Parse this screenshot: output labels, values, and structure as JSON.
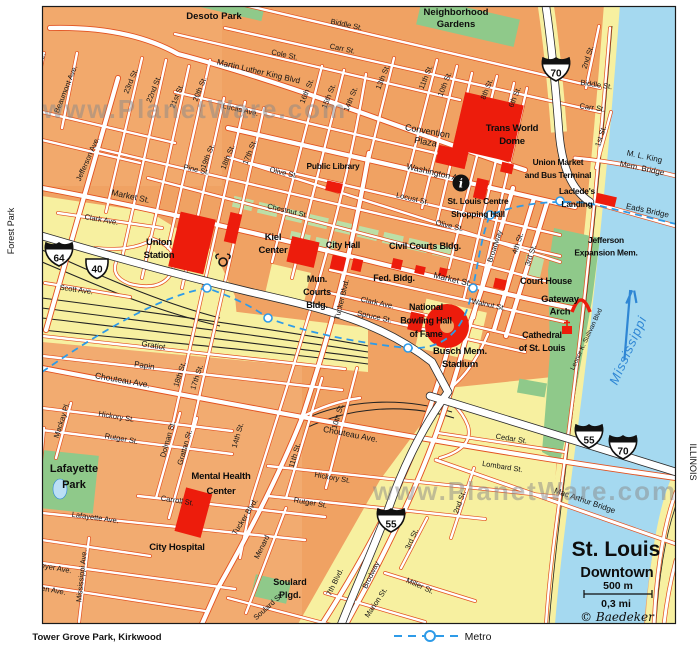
{
  "watermark": "www.PlanetWare.com",
  "title_block": {
    "title": "St. Louis",
    "subtitle": "Downtown",
    "scale_metric": "500 m",
    "scale_imperial": "0,3 mi",
    "credit": "© Baedeker"
  },
  "legend": {
    "metro_label": "Metro",
    "direction_label": "Tower Grove Park, Kirkwood"
  },
  "margin_labels": {
    "left": "Forest Park",
    "right": "ILLINOIS"
  },
  "river_label": "Mississippi",
  "colors": {
    "block_orange": "#f0a263",
    "street_casing": "#e2511f",
    "park_green": "#8fc98a",
    "plaza_green": "#bcdfa6",
    "highway_yellow": "#f7f0a0",
    "river_blue": "#a5d9f0",
    "landmark_red": "#ed1c0c",
    "metro_blue": "#2e9be8"
  },
  "shields": [
    {
      "type": "interstate",
      "num": "70",
      "x": 556,
      "y": 69
    },
    {
      "type": "interstate",
      "num": "64",
      "x": 59,
      "y": 254
    },
    {
      "type": "us",
      "num": "40",
      "x": 97,
      "y": 268
    },
    {
      "type": "interstate",
      "num": "55",
      "x": 391,
      "y": 520
    },
    {
      "type": "interstate",
      "num": "55",
      "x": 589,
      "y": 436
    },
    {
      "type": "interstate",
      "num": "70",
      "x": 623,
      "y": 447
    }
  ],
  "street_labels": [
    {
      "t": "Biddle St.",
      "x": 346,
      "y": 27,
      "r": 12
    },
    {
      "t": "Carr St.",
      "x": 342,
      "y": 51,
      "r": 12
    },
    {
      "t": "Cole St.",
      "x": 284,
      "y": 57,
      "r": 12
    },
    {
      "t": "Martin Luther King Blvd",
      "x": 258,
      "y": 74,
      "r": 13,
      "s": 8.2
    },
    {
      "t": "Lucas Ave.",
      "x": 240,
      "y": 112,
      "r": 13
    },
    {
      "t": "Biddle St.",
      "x": 596,
      "y": 87,
      "r": 8
    },
    {
      "t": "Carr St.",
      "x": 592,
      "y": 110,
      "r": 8
    },
    {
      "l": [
        "Convention",
        "Plaza"
      ],
      "x": 427,
      "y": 134,
      "r": 10,
      "s": 9,
      "lh": 11
    },
    {
      "t": "Washington Ave.",
      "x": 437,
      "y": 176,
      "r": 13,
      "s": 8.5
    },
    {
      "t": "Locust St.",
      "x": 412,
      "y": 201,
      "r": 13
    },
    {
      "t": "Olive St.",
      "x": 283,
      "y": 175,
      "r": 13
    },
    {
      "t": "Olive St.",
      "x": 449,
      "y": 228,
      "r": 13
    },
    {
      "t": "Pine St.",
      "x": 196,
      "y": 172,
      "r": 12
    },
    {
      "t": "Chestnut St.",
      "x": 287,
      "y": 213,
      "r": 13
    },
    {
      "t": "Market St.",
      "x": 130,
      "y": 199,
      "r": 12,
      "s": 8.5
    },
    {
      "t": "Market St.",
      "x": 452,
      "y": 282,
      "r": 13,
      "s": 8.5
    },
    {
      "t": "Walnut St.",
      "x": 488,
      "y": 307,
      "r": 12
    },
    {
      "t": "Clark Ave.",
      "x": 101,
      "y": 222,
      "r": 10
    },
    {
      "t": "Clark Ave.",
      "x": 377,
      "y": 305,
      "r": 12
    },
    {
      "t": "Scott Ave.",
      "x": 76,
      "y": 292,
      "r": 8
    },
    {
      "t": "Spruce St.",
      "x": 374,
      "y": 319,
      "r": 12
    },
    {
      "t": "Gratiot",
      "x": 153,
      "y": 348,
      "r": 9,
      "s": 8
    },
    {
      "t": "Papin",
      "x": 144,
      "y": 368,
      "r": 9,
      "s": 8
    },
    {
      "t": "Chouteau Ave.",
      "x": 122,
      "y": 383,
      "r": 10,
      "s": 8.5
    },
    {
      "t": "Chouteau Ave.",
      "x": 350,
      "y": 437,
      "r": 11,
      "s": 8.5
    },
    {
      "t": "Hickory St.",
      "x": 116,
      "y": 419,
      "r": 10
    },
    {
      "t": "Hickory St.",
      "x": 332,
      "y": 480,
      "r": 10
    },
    {
      "t": "Rutger St.",
      "x": 121,
      "y": 441,
      "r": 10
    },
    {
      "t": "Rutger St.",
      "x": 310,
      "y": 505,
      "r": 10
    },
    {
      "t": "Carroll St.",
      "x": 177,
      "y": 503,
      "r": 9
    },
    {
      "t": "Lafayette Ave.",
      "x": 95,
      "y": 520,
      "r": 8
    },
    {
      "t": "Geyer Ave.",
      "x": 53,
      "y": 570,
      "r": 10
    },
    {
      "t": "Allen Ave.",
      "x": 49,
      "y": 592,
      "r": 10
    },
    {
      "t": "Cedar St.",
      "x": 511,
      "y": 441,
      "r": 9
    },
    {
      "t": "Lombard St.",
      "x": 502,
      "y": 469,
      "r": 9
    },
    {
      "t": "23rd St.",
      "x": 133,
      "y": 82,
      "r": -68
    },
    {
      "t": "22nd St.",
      "x": 156,
      "y": 90,
      "r": -68
    },
    {
      "t": "21st St.",
      "x": 179,
      "y": 97,
      "r": -68
    },
    {
      "t": "20th St.",
      "x": 202,
      "y": 90,
      "r": -68
    },
    {
      "t": "19th St.",
      "x": 210,
      "y": 157,
      "r": -68
    },
    {
      "t": "18th St.",
      "x": 230,
      "y": 158,
      "r": -68
    },
    {
      "t": "17th St.",
      "x": 252,
      "y": 153,
      "r": -68
    },
    {
      "t": "16th St.",
      "x": 309,
      "y": 92,
      "r": -68
    },
    {
      "t": "15th St.",
      "x": 331,
      "y": 97,
      "r": -68
    },
    {
      "t": "14th St.",
      "x": 353,
      "y": 100,
      "r": -68
    },
    {
      "t": "13th St.",
      "x": 385,
      "y": 78,
      "r": -68
    },
    {
      "t": "11th St.",
      "x": 428,
      "y": 78,
      "r": -68
    },
    {
      "t": "10th St.",
      "x": 447,
      "y": 85,
      "r": -68
    },
    {
      "t": "8th St.",
      "x": 489,
      "y": 90,
      "r": -68
    },
    {
      "t": "6th St.",
      "x": 517,
      "y": 98,
      "r": -68
    },
    {
      "t": "2nd St.",
      "x": 590,
      "y": 58,
      "r": -72
    },
    {
      "t": "1st St.",
      "x": 603,
      "y": 137,
      "r": -72
    },
    {
      "t": "Leffingwell Ave.",
      "x": 36,
      "y": 78,
      "r": -68
    },
    {
      "t": "Beaumont Ave.",
      "x": 68,
      "y": 90,
      "r": -68
    },
    {
      "t": "Jefferson Ave.",
      "x": 90,
      "y": 160,
      "r": -66
    },
    {
      "t": "Tucker Blvd.",
      "x": 344,
      "y": 300,
      "r": -76
    },
    {
      "t": "Tucker Blvd.",
      "x": 247,
      "y": 518,
      "r": -58
    },
    {
      "t": "Broadway",
      "x": 497,
      "y": 247,
      "r": -72
    },
    {
      "t": "4th St.",
      "x": 520,
      "y": 244,
      "r": -72
    },
    {
      "t": "3rd St.",
      "x": 533,
      "y": 256,
      "r": -72
    },
    {
      "t": "18th St.",
      "x": 182,
      "y": 375,
      "r": -72
    },
    {
      "t": "17th St.",
      "x": 199,
      "y": 378,
      "r": -72
    },
    {
      "t": "14th St.",
      "x": 240,
      "y": 436,
      "r": -74
    },
    {
      "t": "11th St.",
      "x": 297,
      "y": 456,
      "r": -74
    },
    {
      "t": "10th St.",
      "x": 340,
      "y": 417,
      "r": -74
    },
    {
      "t": "Dolman St.",
      "x": 170,
      "y": 440,
      "r": -74
    },
    {
      "t": "Grattan St.",
      "x": 187,
      "y": 448,
      "r": -74
    },
    {
      "t": "Mackay Pl.",
      "x": 64,
      "y": 421,
      "r": -72
    },
    {
      "t": "Missouri Ave.",
      "x": 37,
      "y": 458,
      "r": -81
    },
    {
      "t": "Mississippi Ave.",
      "x": 84,
      "y": 576,
      "r": -84
    },
    {
      "t": "Menard",
      "x": 264,
      "y": 548,
      "r": -64
    },
    {
      "t": "Soulard St.",
      "x": 270,
      "y": 608,
      "r": -42
    },
    {
      "t": "7th Blvd.",
      "x": 337,
      "y": 583,
      "r": -64
    },
    {
      "t": "Brodway",
      "x": 373,
      "y": 576,
      "r": -64
    },
    {
      "t": "Marion St.",
      "x": 378,
      "y": 604,
      "r": -56
    },
    {
      "t": "Miller St.",
      "x": 419,
      "y": 588,
      "r": 24
    },
    {
      "t": "3rd St.",
      "x": 414,
      "y": 540,
      "r": -66
    },
    {
      "t": "2nd St.",
      "x": 462,
      "y": 503,
      "r": -70
    },
    {
      "t": "Leonor K. Sullivan Blvd",
      "x": 588,
      "y": 340,
      "r": -65,
      "s": 6.5
    }
  ],
  "landmark_labels": [
    {
      "l": [
        "Trans World",
        "Dome"
      ],
      "x": 512,
      "y": 131,
      "s": 9.5,
      "lh": 13
    },
    {
      "l": [
        "Union Market",
        "and Bus Terminal"
      ],
      "x": 558,
      "y": 165,
      "lh": 13
    },
    {
      "l": [
        "Laclede's",
        "Landing"
      ],
      "x": 577,
      "y": 194,
      "lh": 13
    },
    {
      "l": [
        "St. Louis Centre",
        "Shopping Hall"
      ],
      "x": 478,
      "y": 204,
      "lh": 13
    },
    {
      "l": [
        "Public Library"
      ],
      "x": 333,
      "y": 169
    },
    {
      "l": [
        "Union",
        "Station"
      ],
      "x": 159,
      "y": 245,
      "s": 9.5,
      "lh": 13
    },
    {
      "l": [
        "Kiel",
        "Center"
      ],
      "x": 273,
      "y": 240,
      "s": 9.5,
      "lh": 13
    },
    {
      "l": [
        "City Hall"
      ],
      "x": 343,
      "y": 248,
      "s": 9
    },
    {
      "l": [
        "Civil Courts Bldg."
      ],
      "x": 425,
      "y": 249,
      "s": 9
    },
    {
      "l": [
        "Mun.",
        "Courts",
        "Bldg."
      ],
      "x": 317,
      "y": 282,
      "s": 9,
      "lh": 13
    },
    {
      "l": [
        "Fed. Bldg."
      ],
      "x": 394,
      "y": 281,
      "s": 9
    },
    {
      "l": [
        "National",
        "Bowling Hall",
        "of Fame"
      ],
      "x": 426,
      "y": 310,
      "s": 9,
      "lh": 13.5
    },
    {
      "l": [
        "Busch Mem.",
        "Stadium"
      ],
      "x": 460,
      "y": 354,
      "s": 9.5,
      "lh": 13
    },
    {
      "l": [
        "Court House"
      ],
      "x": 546,
      "y": 284,
      "s": 9
    },
    {
      "l": [
        "Gateway",
        "Arch"
      ],
      "x": 560,
      "y": 302,
      "s": 9.5,
      "lh": 12.5
    },
    {
      "l": [
        "Cathedral",
        "of St. Louis"
      ],
      "x": 542,
      "y": 338,
      "s": 9,
      "lh": 13
    },
    {
      "l": [
        "Jefferson",
        "Expansion Mem."
      ],
      "x": 606,
      "y": 243,
      "lh": 12.5
    },
    {
      "l": [
        "Mental Health",
        "Center"
      ],
      "x": 221,
      "y": 479,
      "s": 9.5,
      "lh": 15
    },
    {
      "l": [
        "City Hospital"
      ],
      "x": 177,
      "y": 550,
      "s": 9.5
    }
  ],
  "park_labels": [
    {
      "l": [
        "Desoto Park"
      ],
      "x": 214,
      "y": 19
    },
    {
      "l": [
        "Neighborhood",
        "Gardens"
      ],
      "x": 456,
      "y": 15,
      "lh": 12
    },
    {
      "l": [
        "Lafayette",
        "Park"
      ],
      "x": 74,
      "y": 472,
      "s": 11,
      "lh": 16
    },
    {
      "l": [
        "Soulard",
        "Plgd."
      ],
      "x": 290,
      "y": 585,
      "s": 9,
      "lh": 13
    }
  ],
  "bridge_labels": [
    {
      "l": [
        "M. L. King",
        "Mem. Bridge"
      ],
      "x": 644,
      "y": 159,
      "r": 12,
      "lh": 12
    },
    {
      "l": [
        "Eads Bridge"
      ],
      "x": 647,
      "y": 213,
      "r": 12
    },
    {
      "l": [
        "Mac Arthur Bridge"
      ],
      "x": 584,
      "y": 503,
      "r": 19
    }
  ]
}
